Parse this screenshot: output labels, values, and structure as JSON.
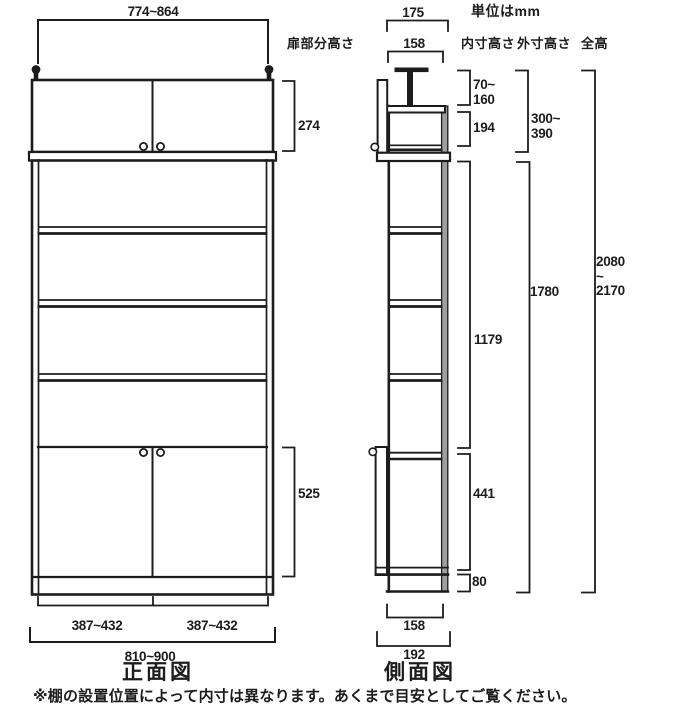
{
  "unit_note": "単位はmm",
  "front": {
    "title": "正面図",
    "top_width": "774~864",
    "door_section_label": "扉部分高さ",
    "upper_door_height": "274",
    "lower_door_height": "525",
    "bottom_width_left": "387~432",
    "bottom_width_right": "387~432",
    "total_width": "810~900"
  },
  "side": {
    "title": "側面図",
    "top_depth": "175",
    "top_inner_depth": "158",
    "bottom_inner_depth": "158",
    "total_depth": "192",
    "columns": {
      "inner": "内寸高さ",
      "outer": "外寸高さ",
      "total": "全高"
    },
    "top_gap_height": [
      "70~",
      "160"
    ],
    "upper_inner_height": "194",
    "upper_outer_height": [
      "300~",
      "390"
    ],
    "open_inner_height": "1179",
    "lower_outer_height": "1780",
    "lower_inner_height": "441",
    "base_height": "80",
    "total_height": [
      "2080",
      "~",
      "2170"
    ]
  },
  "footer": {
    "note": "※棚の設置位置によって内寸は異なります。あくまで目安としてご覧ください。"
  },
  "colors": {
    "line": "#1c1c1c",
    "back_panel": "#9e9e9e"
  }
}
